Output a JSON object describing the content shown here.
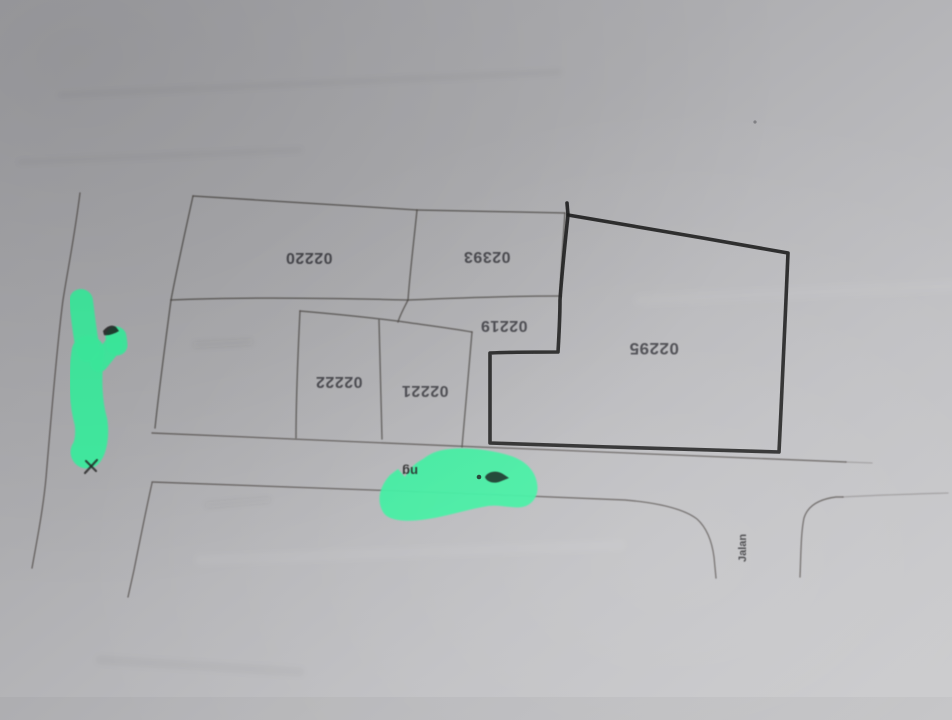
{
  "map": {
    "type": "scanned-cadastral-plot-plan",
    "orientation_note": "labels appear rotated 180 degrees (upside-down scan)",
    "parcels": [
      {
        "id": "02220"
      },
      {
        "id": "02393"
      },
      {
        "id": "02219"
      },
      {
        "id": "02222"
      },
      {
        "id": "02221"
      },
      {
        "id": "02295"
      }
    ],
    "highlighted_parcel": "02295",
    "street_label": "Jalan",
    "covered_street_fragment": "ng",
    "colors": {
      "highlighter_green": "#3defa0",
      "thin_ink": "#4e4a46",
      "thick_outline_ink": "#171717",
      "label_ink": "#3b3b3f",
      "paper_dark": "#a3a3a7",
      "paper_light": "#cacacc"
    }
  }
}
